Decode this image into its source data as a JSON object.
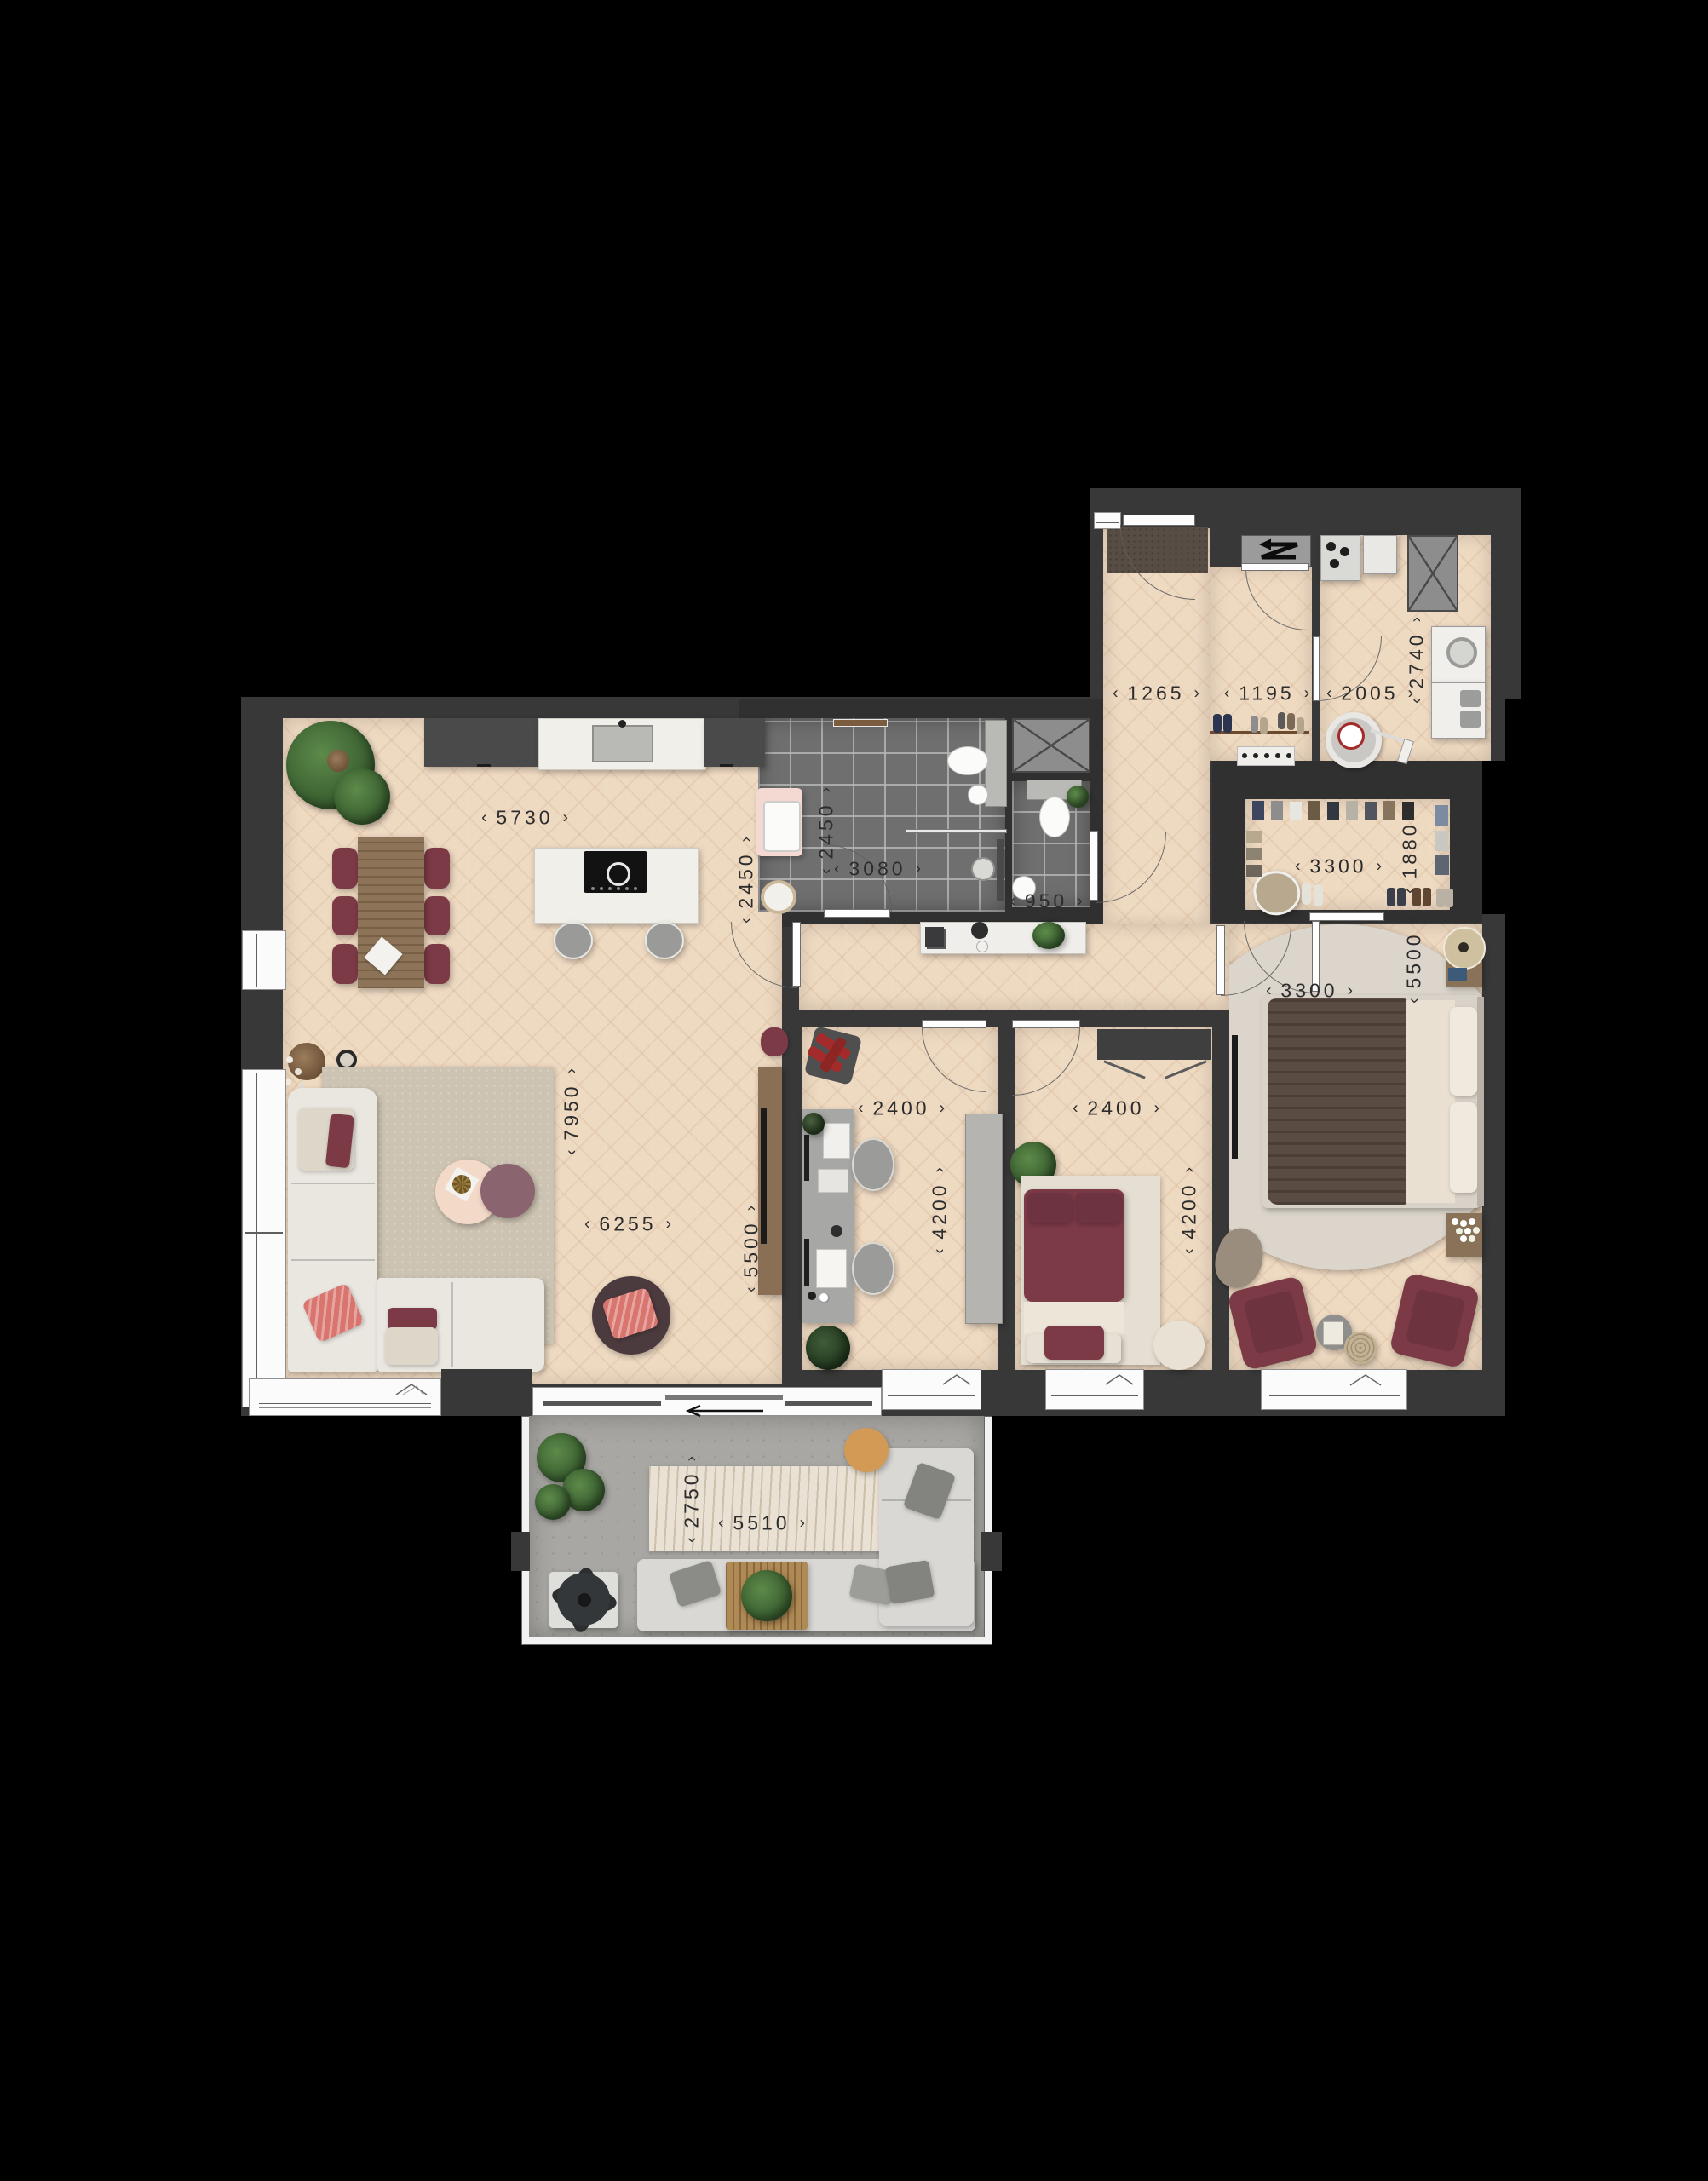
{
  "ui": {
    "dim_arrow_left": "‹",
    "dim_arrow_right": "›"
  },
  "dims": [
    {
      "id": "kitchen-width",
      "value": "5730"
    },
    {
      "id": "kitchen-depth",
      "value": "2450"
    },
    {
      "id": "bathroom-depth",
      "value": "2450"
    },
    {
      "id": "bathroom-width",
      "value": "3080"
    },
    {
      "id": "wc-width",
      "value": "950"
    },
    {
      "id": "corridor-width",
      "value": "1265"
    },
    {
      "id": "vestibule-width",
      "value": "1195"
    },
    {
      "id": "utility-width",
      "value": "2005"
    },
    {
      "id": "utility-depth",
      "value": "2740"
    },
    {
      "id": "closet-width",
      "value": "3300"
    },
    {
      "id": "closet-depth",
      "value": "1880"
    },
    {
      "id": "bedroom-width",
      "value": "3300"
    },
    {
      "id": "bedroom-depth",
      "value": "5500"
    },
    {
      "id": "study-width",
      "value": "2400"
    },
    {
      "id": "study-depth",
      "value": "4200"
    },
    {
      "id": "bedroom2-width",
      "value": "2400"
    },
    {
      "id": "bedroom2-depth",
      "value": "4200"
    },
    {
      "id": "living-total-depth",
      "value": "7950"
    },
    {
      "id": "living-width",
      "value": "6255"
    },
    {
      "id": "living-depth",
      "value": "5500"
    },
    {
      "id": "balcony-depth",
      "value": "2750"
    },
    {
      "id": "balcony-width",
      "value": "5510"
    }
  ],
  "palette": {
    "background": "#000000",
    "wall": "#383838",
    "wood_floor": "#eed9c1",
    "bathroom_tile": "#6f6f6f",
    "balcony_concrete": "#a8a7a3",
    "accent_maroon": "#7c3a46",
    "white_furniture": "#eae7e1",
    "dimension_text": "#2c2c2c"
  }
}
